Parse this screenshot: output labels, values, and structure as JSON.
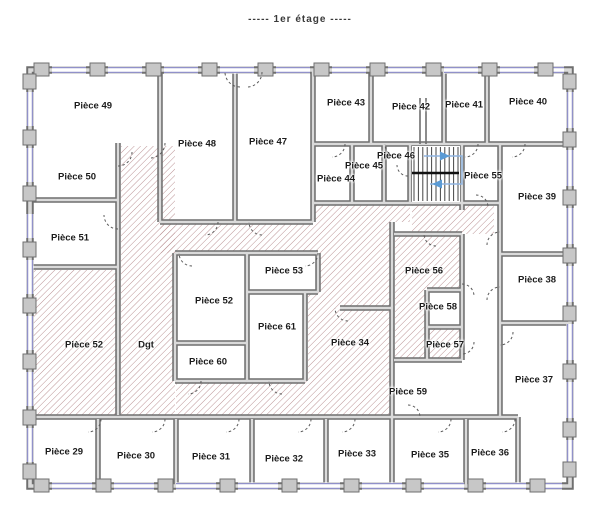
{
  "title": "-----  1er étage  -----",
  "colors": {
    "wall_dark": "#6f6f6f",
    "wall_light": "#dadada",
    "pillar_fill": "#c7c7c7",
    "window_blue": "#9191c9",
    "hatch": "#b5888a",
    "door_arc": "#5a5a5a",
    "stair_line": "#444444",
    "stair_walkline": "#8fb4e0",
    "stair_arrow": "#5b9bd5",
    "label_text": "#1c1c1c"
  },
  "floor_plan": {
    "floor_name": "1er étage",
    "staircase_arrows": [
      "right",
      "left"
    ],
    "corridor_abbreviation": "Dgt",
    "rooms": [
      {
        "label": "Pièce 49",
        "x": 93,
        "y": 106,
        "hatched": false
      },
      {
        "label": "Pièce 48",
        "x": 197,
        "y": 144,
        "hatched": false
      },
      {
        "label": "Pièce 47",
        "x": 268,
        "y": 142,
        "hatched": false
      },
      {
        "label": "Pièce 43",
        "x": 346,
        "y": 103,
        "hatched": false
      },
      {
        "label": "Pièce 42",
        "x": 411,
        "y": 107,
        "hatched": false
      },
      {
        "label": "Pièce 41",
        "x": 464,
        "y": 105,
        "hatched": false
      },
      {
        "label": "Pièce 40",
        "x": 528,
        "y": 102,
        "hatched": false
      },
      {
        "label": "Pièce 50",
        "x": 77,
        "y": 177,
        "hatched": false
      },
      {
        "label": "Pièce 44",
        "x": 336,
        "y": 179,
        "hatched": false
      },
      {
        "label": "Pièce 45",
        "x": 364,
        "y": 166,
        "hatched": false
      },
      {
        "label": "Pièce 46",
        "x": 396,
        "y": 156,
        "hatched": false
      },
      {
        "label": "Pièce 55",
        "x": 483,
        "y": 176,
        "hatched": false
      },
      {
        "label": "Pièce 39",
        "x": 537,
        "y": 197,
        "hatched": false
      },
      {
        "label": "Pièce 51",
        "x": 70,
        "y": 238,
        "hatched": false
      },
      {
        "label": "Pièce 53",
        "x": 284,
        "y": 271,
        "hatched": false
      },
      {
        "label": "Pièce 56",
        "x": 424,
        "y": 271,
        "hatched": true
      },
      {
        "label": "Pièce 38",
        "x": 537,
        "y": 280,
        "hatched": false
      },
      {
        "label": "Pièce 52",
        "x": 214,
        "y": 301,
        "hatched": false
      },
      {
        "label": "Pièce 58",
        "x": 438,
        "y": 307,
        "hatched": false
      },
      {
        "label": "Pièce 61",
        "x": 277,
        "y": 327,
        "hatched": false
      },
      {
        "label": "Pièce 34",
        "x": 350,
        "y": 343,
        "hatched": true
      },
      {
        "label": "Pièce 52",
        "x": 84,
        "y": 345,
        "hatched": true
      },
      {
        "label": "Dgt",
        "x": 146,
        "y": 345,
        "hatched": true
      },
      {
        "label": "Pièce 57",
        "x": 445,
        "y": 345,
        "hatched": true
      },
      {
        "label": "Pièce 60",
        "x": 208,
        "y": 362,
        "hatched": false
      },
      {
        "label": "Pièce 37",
        "x": 534,
        "y": 380,
        "hatched": false
      },
      {
        "label": "Pièce 59",
        "x": 408,
        "y": 392,
        "hatched": false
      },
      {
        "label": "Pièce 29",
        "x": 64,
        "y": 452,
        "hatched": false
      },
      {
        "label": "Pièce 30",
        "x": 136,
        "y": 456,
        "hatched": false
      },
      {
        "label": "Pièce 31",
        "x": 211,
        "y": 457,
        "hatched": false
      },
      {
        "label": "Pièce 32",
        "x": 284,
        "y": 459,
        "hatched": false
      },
      {
        "label": "Pièce 33",
        "x": 357,
        "y": 454,
        "hatched": false
      },
      {
        "label": "Pièce 35",
        "x": 430,
        "y": 455,
        "hatched": false
      },
      {
        "label": "Pièce 36",
        "x": 490,
        "y": 453,
        "hatched": false
      }
    ]
  }
}
